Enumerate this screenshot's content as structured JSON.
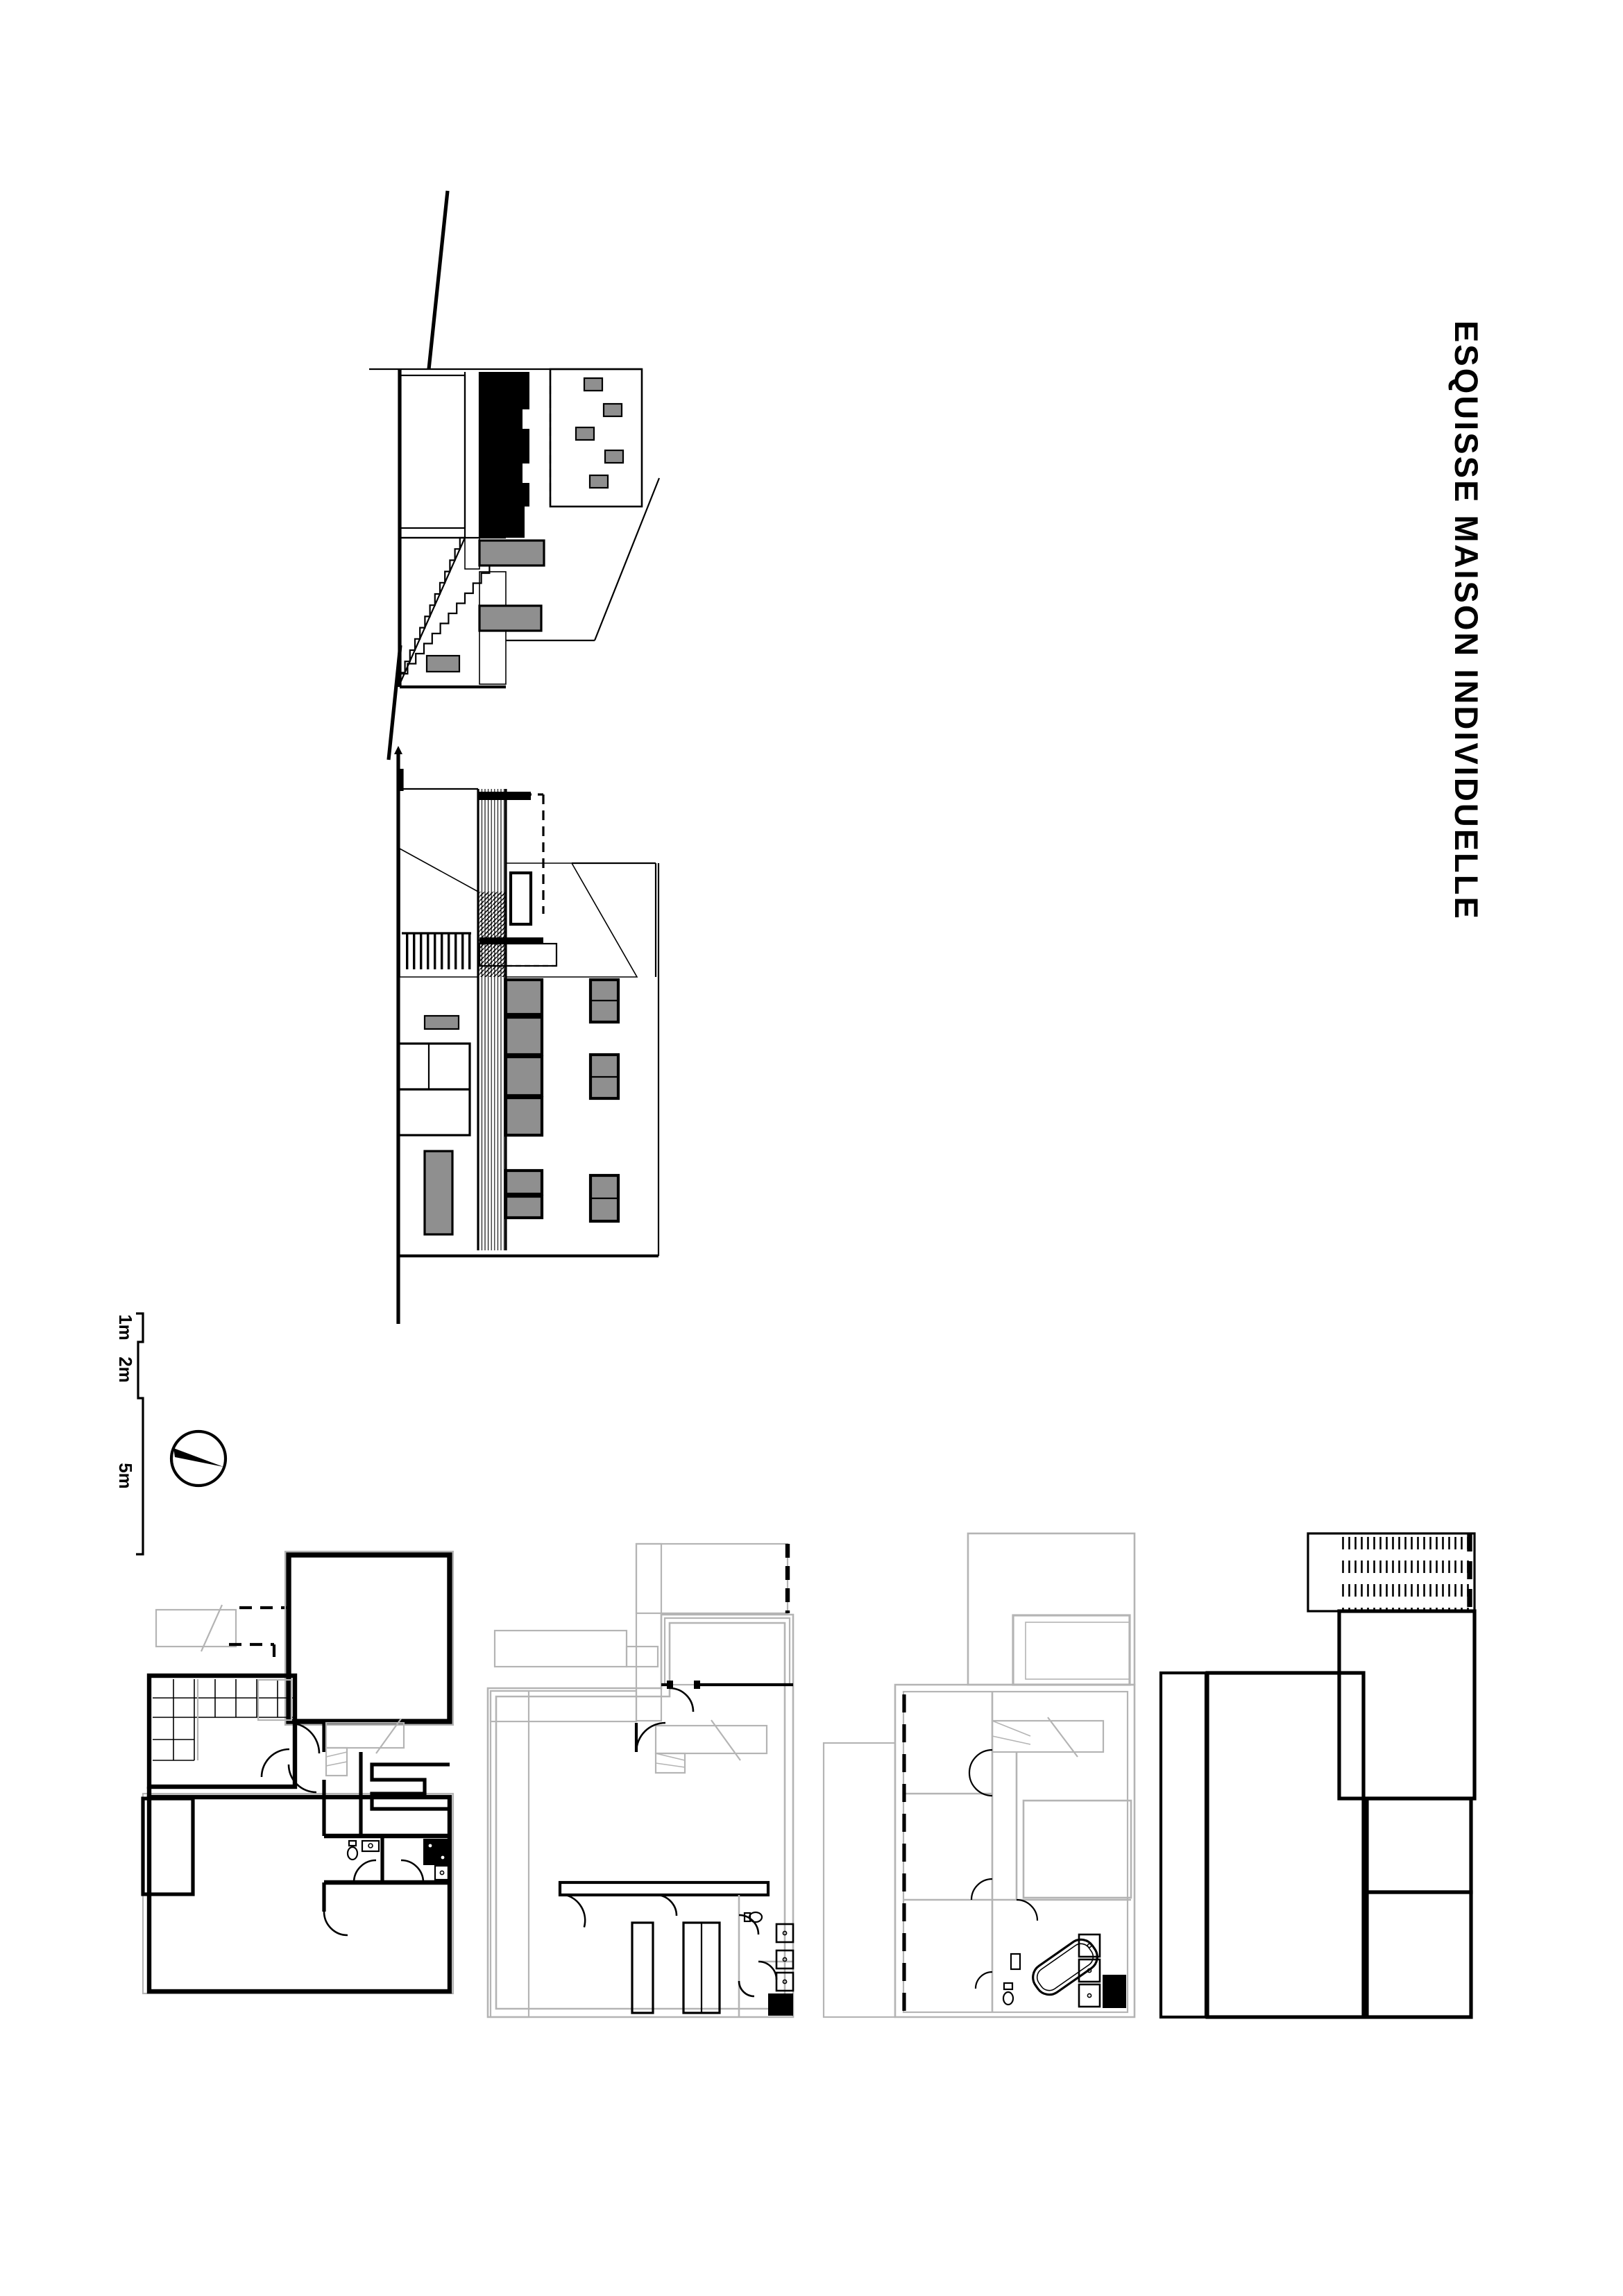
{
  "title": {
    "text": "ESQUISSE MAISON INDIVIDUELLE"
  },
  "scale_bar": {
    "labels": [
      "1m",
      "2m",
      "5m"
    ]
  },
  "palette": {
    "ink": "#000000",
    "window_gray": "#8f8f8f",
    "guide_gray": "#b4b4b4",
    "background": "#ffffff"
  }
}
